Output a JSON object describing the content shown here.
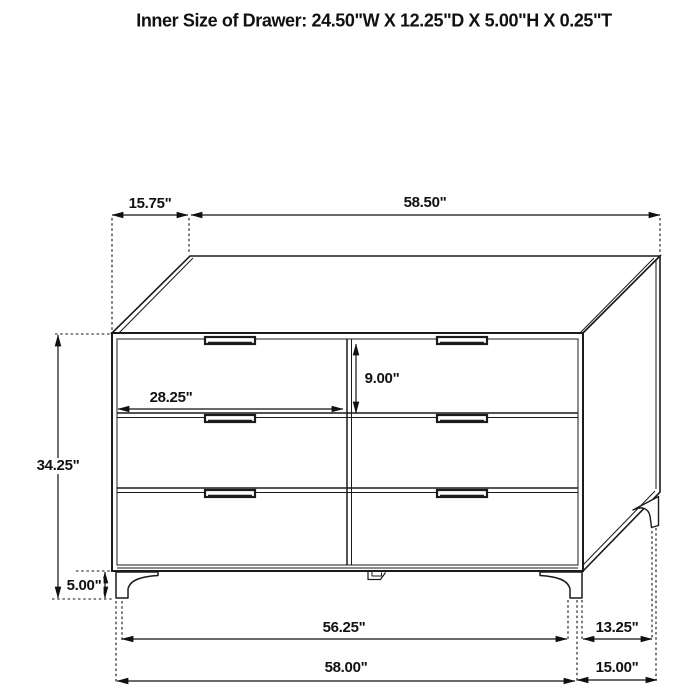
{
  "title": "Inner Size of Drawer: 24.50\"W X 12.25\"D X 5.00\"H X 0.25\"T",
  "drawing": {
    "subject": "six-drawer dresser dimension diagram",
    "style": "black line art on white"
  },
  "dimension_labels": {
    "top_depth": "15.75\"",
    "top_width": "58.50\"",
    "drawer_front_width": "28.25\"",
    "drawer_front_height": "9.00\"",
    "overall_height": "34.25\"",
    "leg_height": "5.00\"",
    "width_between_front_legs": "56.25\"",
    "overall_width": "58.00\"",
    "depth_between_side_legs": "13.25\"",
    "overall_depth": "15.00\""
  }
}
